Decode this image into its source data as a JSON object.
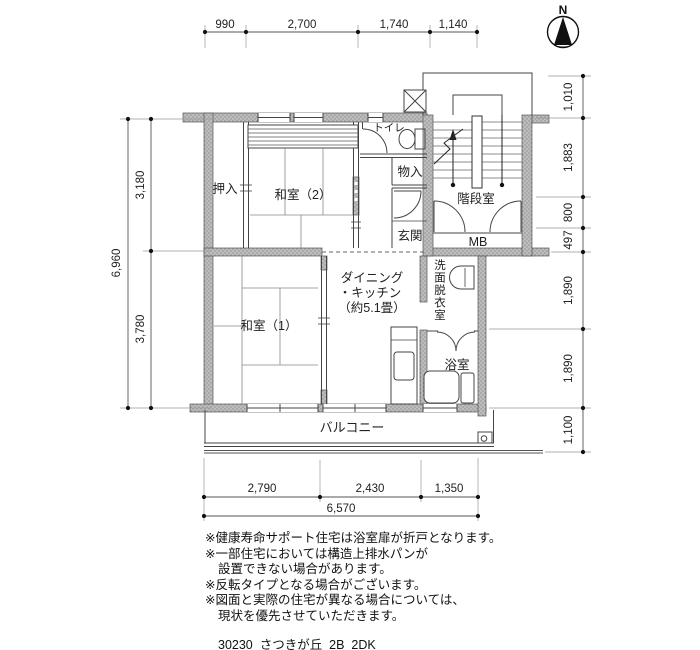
{
  "compass": {
    "label": "N"
  },
  "rooms": {
    "oshiire": "押入",
    "washitsu2": "和室（2）",
    "washitsu1": "和室（1）",
    "toilet": "トイレ",
    "monoire": "物入",
    "genkan": "玄関",
    "kaidan": "階段室",
    "mb": "MB",
    "dk_line1": "ダイニング",
    "dk_line2": "・キッチン",
    "dk_line3": "（約5.1畳）",
    "senmen": "洗面脱衣室",
    "bath": "浴室",
    "balcony": "バルコニー"
  },
  "dimensions": {
    "top": [
      "990",
      "2,700",
      "1,740",
      "1,140"
    ],
    "left_total": "6,960",
    "left": [
      "3,180",
      "3,780"
    ],
    "right": [
      "1,010",
      "1,883",
      "800",
      "497",
      "1,890",
      "1,890",
      "1,100"
    ],
    "bottom": [
      "2,790",
      "2,430",
      "1,350"
    ],
    "bottom_total": "6,570"
  },
  "notes": [
    "※健康寿命サポート住宅は浴室扉が折戸となります。",
    "※一部住宅においては構造上排水パンが",
    "設置できない場合があります。",
    "※反転タイプとなる場合がございます。",
    "※図面と実際の住宅が異なる場合については、",
    "現状を優先させていただきます。"
  ],
  "footer": "30230_さつきが丘_2B_2DK"
}
